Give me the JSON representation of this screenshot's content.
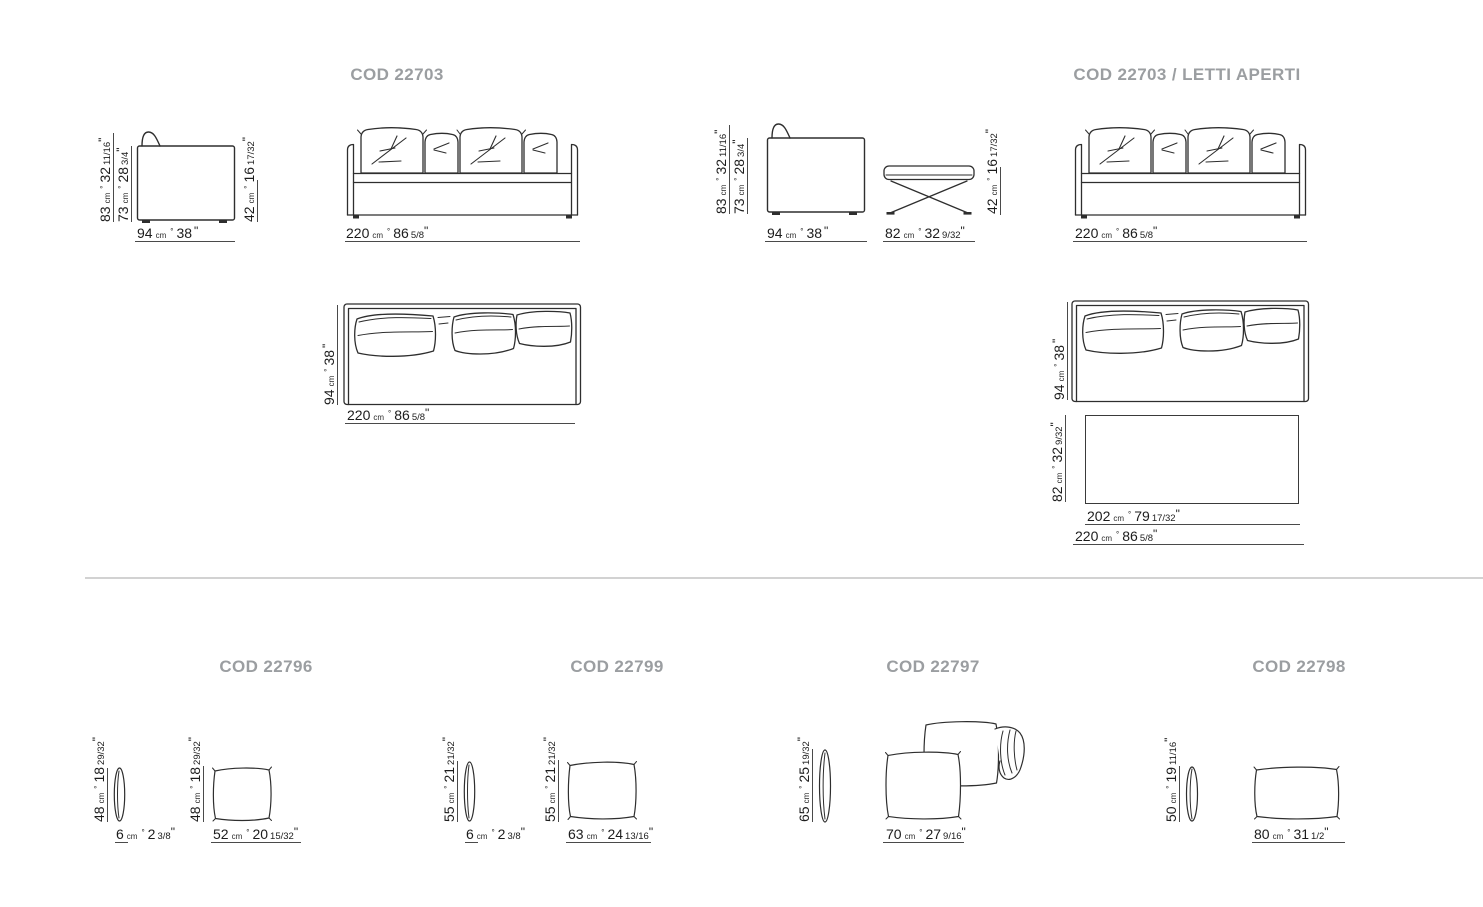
{
  "page": {
    "background": "#ffffff",
    "title_color": "#9b9ea1",
    "line_color": "#2e2e2e",
    "dimension_line_color": "#4a4a4a",
    "divider_color": "#d2d2d2",
    "text_color": "#1c1c1c"
  },
  "units": {
    "cm": "cm",
    "separator": "°",
    "inch_mark": "\""
  },
  "titles": {
    "sofa": "COD 22703",
    "sofa_open_bed": "COD 22703 / LETTI APERTI",
    "cushion_22796": "COD 22796",
    "cushion_22799": "COD 22799",
    "cushion_22797": "COD 22797",
    "cushion_22798": "COD 22798"
  },
  "dims": {
    "d83": {
      "cm": "83",
      "in": "32",
      "frac": "11/16"
    },
    "d73": {
      "cm": "73",
      "in": "28",
      "frac": "3/4"
    },
    "d94": {
      "cm": "94",
      "in": "38",
      "frac": ""
    },
    "d42": {
      "cm": "42",
      "in": "16",
      "frac": "17/32"
    },
    "d220": {
      "cm": "220",
      "in": "86",
      "frac": "5/8"
    },
    "d82": {
      "cm": "82",
      "in": "32",
      "frac": "9/32"
    },
    "d202": {
      "cm": "202",
      "in": "79",
      "frac": "17/32"
    },
    "d48": {
      "cm": "48",
      "in": "18",
      "frac": "29/32"
    },
    "d6": {
      "cm": "6",
      "in": "2",
      "frac": "3/8"
    },
    "d52": {
      "cm": "52",
      "in": "20",
      "frac": "15/32"
    },
    "d55": {
      "cm": "55",
      "in": "21",
      "frac": "21/32"
    },
    "d63": {
      "cm": "63",
      "in": "24",
      "frac": "13/16"
    },
    "d65": {
      "cm": "65",
      "in": "25",
      "frac": "19/32"
    },
    "d70": {
      "cm": "70",
      "in": "27",
      "frac": "9/16"
    },
    "d50": {
      "cm": "50",
      "in": "19",
      "frac": "11/16"
    },
    "d80": {
      "cm": "80",
      "in": "31",
      "frac": "1/2"
    }
  }
}
